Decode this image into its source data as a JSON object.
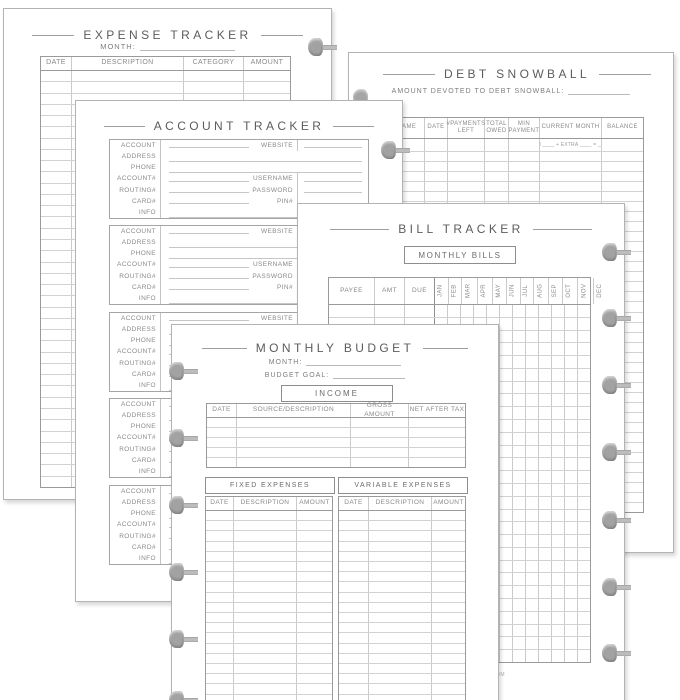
{
  "colors": {
    "page_edge": "#b3b3b3",
    "rule_line": "#9e9e9e",
    "table_inner_line": "#cbcbcb",
    "text_gray": "#6c6c6c",
    "disc_gray": "#a2a2a2"
  },
  "watermark": "OM",
  "pages": {
    "expense_tracker": {
      "title": "EXPENSE TRACKER",
      "month_label": "MONTH:",
      "columns": [
        "DATE",
        "DESCRIPTION",
        "CATEGORY",
        "AMOUNT"
      ],
      "rows": 37
    },
    "debt_snowball": {
      "title": "DEBT SNOWBALL",
      "subtitle": "AMOUNT DEVOTED TO DEBT SNOWBALL:",
      "columns": [
        "DEBT NAME",
        "DATE",
        "#PAYMENTS LEFT",
        "TOTAL OWED",
        "MIN PAYMENT",
        "CURRENT MONTH",
        "BALANCE"
      ],
      "current_month_formula": "MIN ____ + EXTRA ____ = ____",
      "rows": 36
    },
    "account_tracker": {
      "title": "ACCOUNT TRACKER",
      "row_labels": [
        "ACCOUNT",
        "ADDRESS",
        "PHONE",
        "ACCOUNT#",
        "ROUTING#",
        "CARD#",
        "INFO"
      ],
      "side_labels": [
        "WEBSITE",
        "USERNAME",
        "PASSWORD",
        "PIN#"
      ],
      "blocks": 5
    },
    "bill_tracker": {
      "title": "BILL TRACKER",
      "section_label": "MONTHLY BILLS",
      "columns": [
        "PAYEE",
        "AMT",
        "DUE"
      ],
      "months": [
        "JAN",
        "FEB",
        "MAR",
        "APR",
        "MAY",
        "JUN",
        "JUL",
        "AUG",
        "SEP",
        "OCT",
        "NOV",
        "DEC"
      ],
      "rows": 28
    },
    "monthly_budget": {
      "title": "MONTHLY BUDGET",
      "month_label": "MONTH:",
      "goal_label": "BUDGET GOAL:",
      "income_label": "INCOME",
      "income_columns": [
        "DATE",
        "SOURCE/DESCRIPTION",
        "GROSS AMOUNT",
        "NET AFTER TAX"
      ],
      "income_rows": 5,
      "fixed_label": "FIXED EXPENSES",
      "variable_label": "VARIABLE EXPENSES",
      "expense_columns": [
        "DATE",
        "DESCRIPTION",
        "AMOUNT"
      ],
      "expense_rows": 20
    }
  }
}
